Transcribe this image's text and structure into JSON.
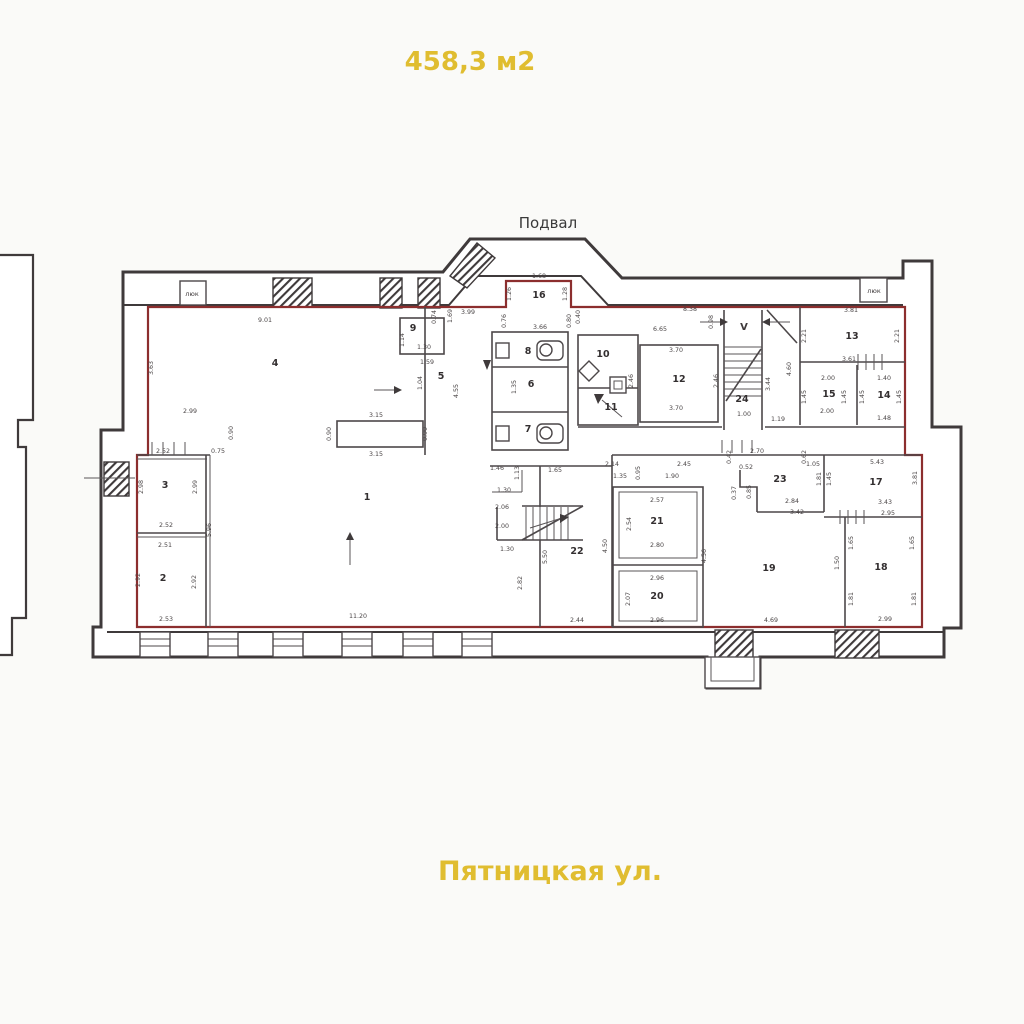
{
  "meta": {
    "floor_area": "458,3 м2",
    "floor_label": "Подвал",
    "street_label": "Пятницкая ул."
  },
  "colors": {
    "accent_yellow": "#e0bd30",
    "outer_wall": "#3f3a3b",
    "leased_boundary_red": "#8c2e2e",
    "interior_wall_gray": "#4c4749",
    "dim_text": "#4a4546",
    "background": "#fafaf8"
  },
  "rooms": [
    {
      "n": "1",
      "x": 367,
      "y": 500
    },
    {
      "n": "2",
      "x": 163,
      "y": 581
    },
    {
      "n": "3",
      "x": 165,
      "y": 488
    },
    {
      "n": "4",
      "x": 275,
      "y": 366
    },
    {
      "n": "5",
      "x": 441,
      "y": 379
    },
    {
      "n": "6",
      "x": 531,
      "y": 387
    },
    {
      "n": "7",
      "x": 528,
      "y": 432
    },
    {
      "n": "8",
      "x": 528,
      "y": 354
    },
    {
      "n": "9",
      "x": 413,
      "y": 331
    },
    {
      "n": "10",
      "x": 603,
      "y": 357
    },
    {
      "n": "11",
      "x": 611,
      "y": 410
    },
    {
      "n": "12",
      "x": 679,
      "y": 382
    },
    {
      "n": "13",
      "x": 852,
      "y": 339
    },
    {
      "n": "14",
      "x": 884,
      "y": 398
    },
    {
      "n": "15",
      "x": 829,
      "y": 397
    },
    {
      "n": "16",
      "x": 539,
      "y": 298
    },
    {
      "n": "17",
      "x": 876,
      "y": 485
    },
    {
      "n": "18",
      "x": 881,
      "y": 570
    },
    {
      "n": "19",
      "x": 769,
      "y": 571
    },
    {
      "n": "20",
      "x": 657,
      "y": 599
    },
    {
      "n": "21",
      "x": 657,
      "y": 524
    },
    {
      "n": "22",
      "x": 577,
      "y": 554
    },
    {
      "n": "23",
      "x": 780,
      "y": 482
    },
    {
      "n": "24",
      "x": 742,
      "y": 402
    }
  ],
  "dims": [
    [
      "9.01",
      265,
      322,
      0
    ],
    [
      "3.63",
      153,
      368,
      1
    ],
    [
      "1.69",
      452,
      316,
      1
    ],
    [
      "0.74",
      436,
      317,
      1
    ],
    [
      "3.99",
      468,
      314,
      0
    ],
    [
      "3.66",
      540,
      329,
      0
    ],
    [
      "0.40",
      580,
      317,
      1
    ],
    [
      "1.68",
      539,
      278,
      0
    ],
    [
      "1.26",
      511,
      294,
      1
    ],
    [
      "1.28",
      567,
      294,
      1
    ],
    [
      "0.76",
      506,
      321,
      1
    ],
    [
      "0.80",
      571,
      321,
      1
    ],
    [
      "8.38",
      690,
      311,
      0
    ],
    [
      "0.98",
      713,
      322,
      1
    ],
    [
      "6.65",
      660,
      331,
      0
    ],
    [
      "3.70",
      676,
      352,
      0
    ],
    [
      "3.70",
      676,
      410,
      0
    ],
    [
      "2.46",
      633,
      381,
      1
    ],
    [
      "2.46",
      718,
      381,
      1
    ],
    [
      "3.44",
      770,
      384,
      1
    ],
    [
      "4.60",
      791,
      369,
      1
    ],
    [
      "1.00",
      744,
      416,
      0
    ],
    [
      "1.19",
      778,
      421,
      0
    ],
    [
      "3.81",
      851,
      312,
      0
    ],
    [
      "2.21",
      806,
      336,
      1
    ],
    [
      "2.21",
      899,
      336,
      1
    ],
    [
      "3.61",
      849,
      361,
      0
    ],
    [
      "2.00",
      828,
      380,
      0
    ],
    [
      "2.00",
      827,
      413,
      0
    ],
    [
      "1.45",
      806,
      397,
      1
    ],
    [
      "1.45",
      846,
      397,
      1
    ],
    [
      "1.40",
      884,
      380,
      0
    ],
    [
      "1.45",
      864,
      397,
      1
    ],
    [
      "1.45",
      901,
      397,
      1
    ],
    [
      "1.48",
      884,
      420,
      0
    ],
    [
      "1.30",
      424,
      349,
      0
    ],
    [
      "1.14",
      404,
      340,
      1
    ],
    [
      "1.59",
      427,
      364,
      0
    ],
    [
      "4.55",
      458,
      391,
      1
    ],
    [
      "1.04",
      422,
      383,
      1
    ],
    [
      "1.35",
      516,
      387,
      1
    ],
    [
      "2.99",
      190,
      413,
      0
    ],
    [
      "0.90",
      233,
      433,
      1
    ],
    [
      "3.15",
      376,
      417,
      0
    ],
    [
      "3.15",
      376,
      456,
      0
    ],
    [
      "0.90",
      331,
      434,
      1
    ],
    [
      "0.90",
      427,
      434,
      1
    ],
    [
      "2.52",
      163,
      453,
      0
    ],
    [
      "0.75",
      218,
      453,
      0
    ],
    [
      "2.98",
      143,
      487,
      1
    ],
    [
      "2.99",
      197,
      487,
      1
    ],
    [
      "2.52",
      166,
      527,
      0
    ],
    [
      "2.51",
      165,
      547,
      0
    ],
    [
      "5.96",
      211,
      530,
      1
    ],
    [
      "2.92",
      140,
      580,
      1
    ],
    [
      "2.92",
      196,
      582,
      1
    ],
    [
      "2.53",
      166,
      621,
      0
    ],
    [
      "11.20",
      358,
      618,
      0
    ],
    [
      "2.70",
      757,
      453,
      0
    ],
    [
      "0.42",
      731,
      457,
      1
    ],
    [
      "0.62",
      806,
      457,
      1
    ],
    [
      "1.46",
      497,
      470,
      0
    ],
    [
      "1.13",
      519,
      473,
      1
    ],
    [
      "1.65",
      555,
      472,
      0
    ],
    [
      "1.30",
      504,
      492,
      0
    ],
    [
      "2.06",
      502,
      509,
      0
    ],
    [
      "2.00",
      502,
      528,
      0
    ],
    [
      "1.30",
      507,
      551,
      0
    ],
    [
      "5.50",
      547,
      557,
      1
    ],
    [
      "2.82",
      522,
      583,
      1
    ],
    [
      "2.44",
      577,
      622,
      0
    ],
    [
      "2.14",
      612,
      466,
      0
    ],
    [
      "2.45",
      684,
      466,
      0
    ],
    [
      "1.35",
      620,
      478,
      0
    ],
    [
      "1.90",
      672,
      478,
      0
    ],
    [
      "0.95",
      640,
      473,
      1
    ],
    [
      "2.57",
      657,
      502,
      0
    ],
    [
      "2.54",
      631,
      524,
      1
    ],
    [
      "2.80",
      657,
      547,
      0
    ],
    [
      "2.96",
      657,
      580,
      0
    ],
    [
      "2.07",
      630,
      599,
      1
    ],
    [
      "2.96",
      657,
      622,
      0
    ],
    [
      "4.56",
      706,
      556,
      1
    ],
    [
      "4.50",
      607,
      546,
      1
    ],
    [
      "0.52",
      746,
      469,
      0
    ],
    [
      "0.37",
      736,
      493,
      1
    ],
    [
      "0.85",
      751,
      492,
      1
    ],
    [
      "2.84",
      792,
      503,
      0
    ],
    [
      "3.42",
      797,
      514,
      0
    ],
    [
      "1.05",
      813,
      466,
      0
    ],
    [
      "1.81",
      821,
      479,
      1
    ],
    [
      "1.45",
      831,
      479,
      1
    ],
    [
      "5.43",
      877,
      464,
      0
    ],
    [
      "3.81",
      917,
      478,
      1
    ],
    [
      "3.43",
      885,
      504,
      0
    ],
    [
      "2.95",
      888,
      515,
      0
    ],
    [
      "4.69",
      771,
      622,
      0
    ],
    [
      "1.50",
      839,
      563,
      1
    ],
    [
      "1.65",
      853,
      543,
      1
    ],
    [
      "1.65",
      914,
      543,
      1
    ],
    [
      "1.81",
      853,
      599,
      1
    ],
    [
      "1.81",
      916,
      599,
      1
    ],
    [
      "2.99",
      885,
      621,
      0
    ]
  ],
  "misc_labels": [
    {
      "t": "люк",
      "x": 192,
      "y": 296
    },
    {
      "t": "люк",
      "x": 874,
      "y": 293
    }
  ],
  "stair_mark": "V",
  "windows_x": [
    140,
    208,
    273,
    342,
    403,
    462
  ]
}
